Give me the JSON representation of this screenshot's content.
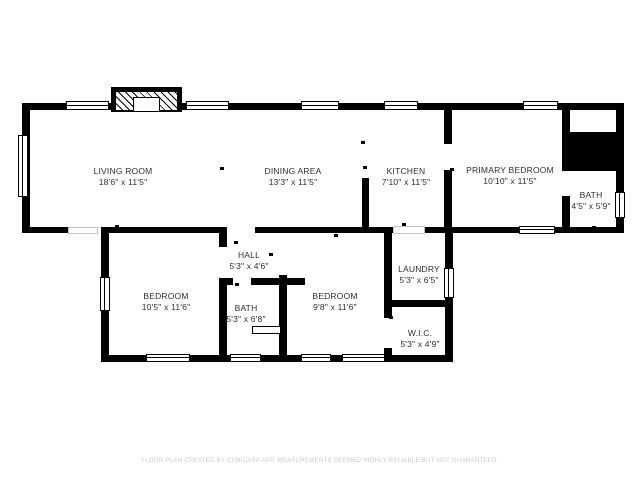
{
  "floor_plan": {
    "rooms": [
      {
        "name": "LIVING ROOM",
        "dims": "18'6\" x 11'5\""
      },
      {
        "name": "DINING AREA",
        "dims": "13'3\" x 11'5\""
      },
      {
        "name": "KITCHEN",
        "dims": "7'10\" x 11'5\""
      },
      {
        "name": "PRIMARY BEDROOM",
        "dims": "10'10\" x 11'5\""
      },
      {
        "name": "BATH",
        "dims": "4'5\" x 5'9\""
      },
      {
        "name": "HALL",
        "dims": "5'3\" x 4'6\""
      },
      {
        "name": "BEDROOM",
        "dims": "10'5\" x 11'6\""
      },
      {
        "name": "BATH",
        "dims": "5'3\" x 6'8\""
      },
      {
        "name": "BEDROOM",
        "dims": "9'8\" x 11'6\""
      },
      {
        "name": "LAUNDRY",
        "dims": "5'3\" x 6'5\""
      },
      {
        "name": "W.I.C.",
        "dims": "5'3\" x 4'9\""
      }
    ],
    "footer": "FLOOR PLAN CREATED BY CUBICASA APP. MEASUREMENTS DEEMED HIGHLY RELIABLE BUT NOT GUARANTEED.",
    "colors": {
      "wall": "#000000",
      "background": "#ffffff",
      "label_text": "#2e2e2e",
      "footer_text": "#c9c9c9"
    }
  }
}
